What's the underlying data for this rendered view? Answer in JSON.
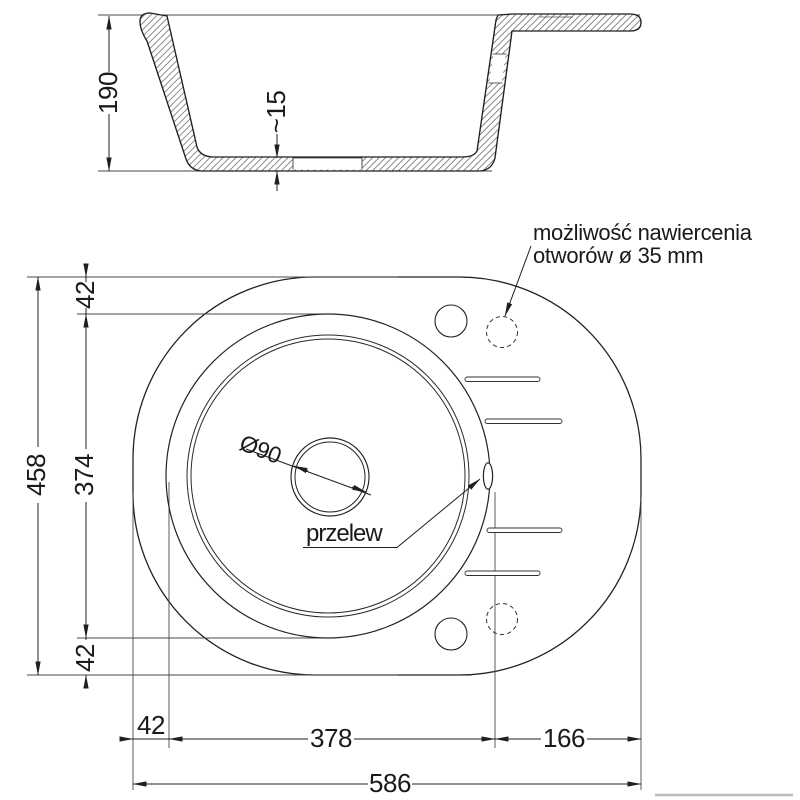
{
  "section_view": {
    "depth_mm": "190",
    "bottom_recess_mm": "~15"
  },
  "plan_view": {
    "total_height_mm": "458",
    "offset_top_mm": "42",
    "bowl_outer_mm": "374",
    "offset_bottom_mm": "42",
    "offset_left_mm": "42",
    "bowl_zone_mm": "378",
    "drainer_zone_mm": "166",
    "total_width_mm": "586",
    "drain_diameter": "Ø90",
    "overflow_label": "przelew",
    "drill_note_line1": "możliwość nawiercenia",
    "drill_note_line2": "otworów ø 35 mm"
  },
  "colors": {
    "line_dark": "#1f1f1f",
    "line_thin": "#4a4a4a",
    "gray_mark": "#b9b9b9"
  }
}
